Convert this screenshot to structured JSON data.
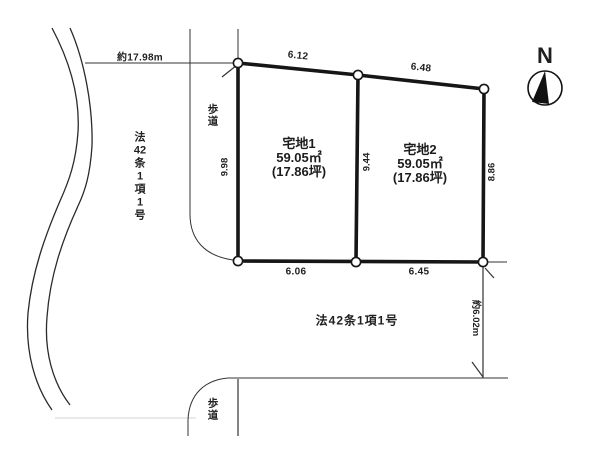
{
  "compass": {
    "north_label": "N"
  },
  "boundary_dimensions": {
    "front_road_width": "約17.98m",
    "plot1_top": "6.12",
    "plot2_top": "6.48",
    "plot1_left": "9.98",
    "center_divider": "9.44",
    "plot2_right": "8.86",
    "plot1_bottom": "6.06",
    "plot2_bottom": "6.45",
    "side_road_width": "約6.02m"
  },
  "plots": [
    {
      "name": "宅地1",
      "area_sqm": "59.05㎡",
      "area_tsubo": "(17.86坪)"
    },
    {
      "name": "宅地2",
      "area_sqm": "59.05㎡",
      "area_tsubo": "(17.86坪)"
    }
  ],
  "roads": {
    "left_road_vertical": [
      "法",
      "42",
      "条",
      "1",
      "項",
      "1",
      "号"
    ],
    "bottom_road": "法42条1項1号",
    "sidewalk_top": [
      "歩",
      "道"
    ],
    "sidewalk_bottom": [
      "歩",
      "道"
    ]
  },
  "colors": {
    "ink": "#1f1f1f",
    "paper": "#ffffff"
  }
}
